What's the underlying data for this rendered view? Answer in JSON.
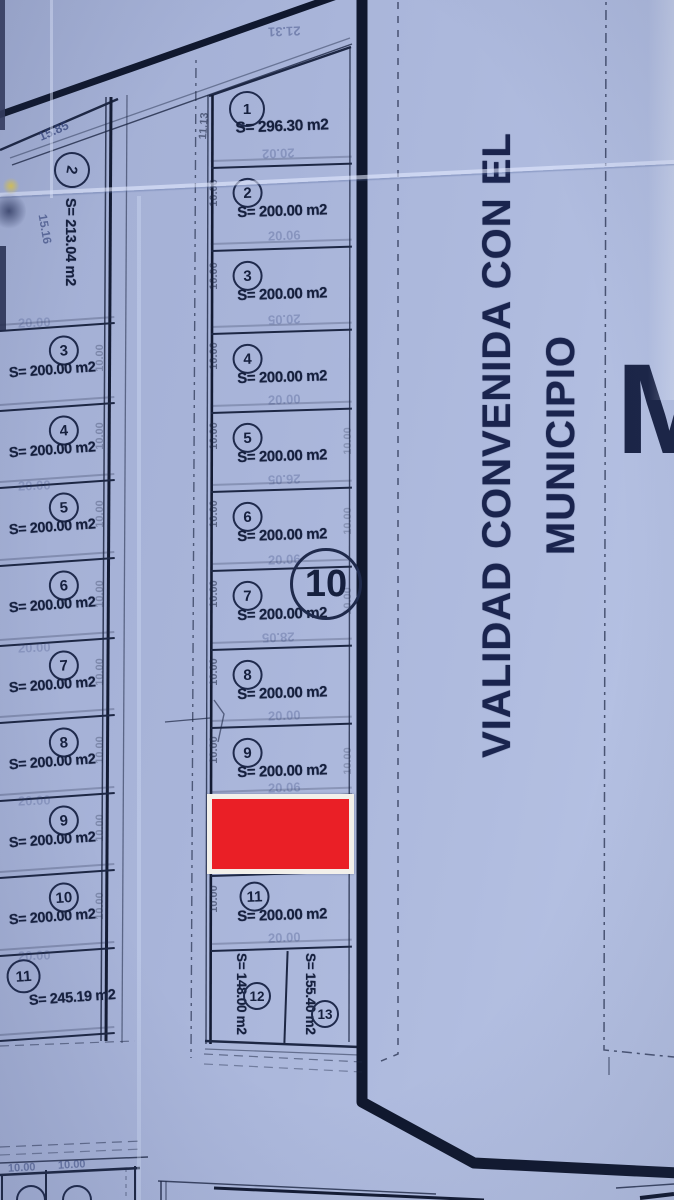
{
  "palette": {
    "paper": "#a9b5da",
    "ink": "#1d2744",
    "boundary": "#10182e",
    "highlight_red": "#ea1f26",
    "highlight_frame": "#f2f0ea"
  },
  "street": {
    "label": "VIALIDAD CONVENIDA CON EL MUNICIPIO"
  },
  "partial_letter": "M",
  "center_block": {
    "block_number": "10",
    "lots": [
      {
        "number": "1",
        "area": "S= 296.30 m2"
      },
      {
        "number": "2",
        "area": "S= 200.00 m2"
      },
      {
        "number": "3",
        "area": "S= 200.00 m2"
      },
      {
        "number": "4",
        "area": "S= 200.00 m2"
      },
      {
        "number": "5",
        "area": "S= 200.00 m2"
      },
      {
        "number": "6",
        "area": "S= 200.00 m2"
      },
      {
        "number": "7",
        "area": "S= 200.00 m2"
      },
      {
        "number": "8",
        "area": "S= 200.00 m2"
      },
      {
        "number": "9",
        "area": "S= 200.00 m2"
      },
      {
        "number": "11",
        "area": "S= 200.00 m2"
      },
      {
        "number": "12",
        "area": "S= 148.00 m2"
      },
      {
        "number": "13",
        "area": "S= 155.40 m2"
      }
    ]
  },
  "left_block": {
    "lots": [
      {
        "number": "2",
        "area": "S= 213.04 m2"
      },
      {
        "number": "3",
        "area": "S= 200.00 m2"
      },
      {
        "number": "4",
        "area": "S= 200.00 m2"
      },
      {
        "number": "5",
        "area": "S= 200.00 m2"
      },
      {
        "number": "6",
        "area": "S= 200.00 m2"
      },
      {
        "number": "7",
        "area": "S= 200.00 m2"
      },
      {
        "number": "8",
        "area": "S= 200.00 m2"
      },
      {
        "number": "9",
        "area": "S= 200.00 m2"
      },
      {
        "number": "10",
        "area": "S= 200.00 m2"
      },
      {
        "number": "11",
        "area": "S= 245.19 m2"
      }
    ]
  },
  "dimensions": {
    "tick": "10.00",
    "top_left": "15.85",
    "left_side": "15.16",
    "lot1_left": "11.13",
    "lot1_top_ghost": "21.31",
    "ghosts": {
      "a": "20.02",
      "b": "20.06",
      "c": "20.05",
      "d": "20.00",
      "e": "26.05",
      "f": "20.06",
      "g": "28.05",
      "h": "20.00",
      "i": "20.06",
      "j": "20.00"
    }
  }
}
